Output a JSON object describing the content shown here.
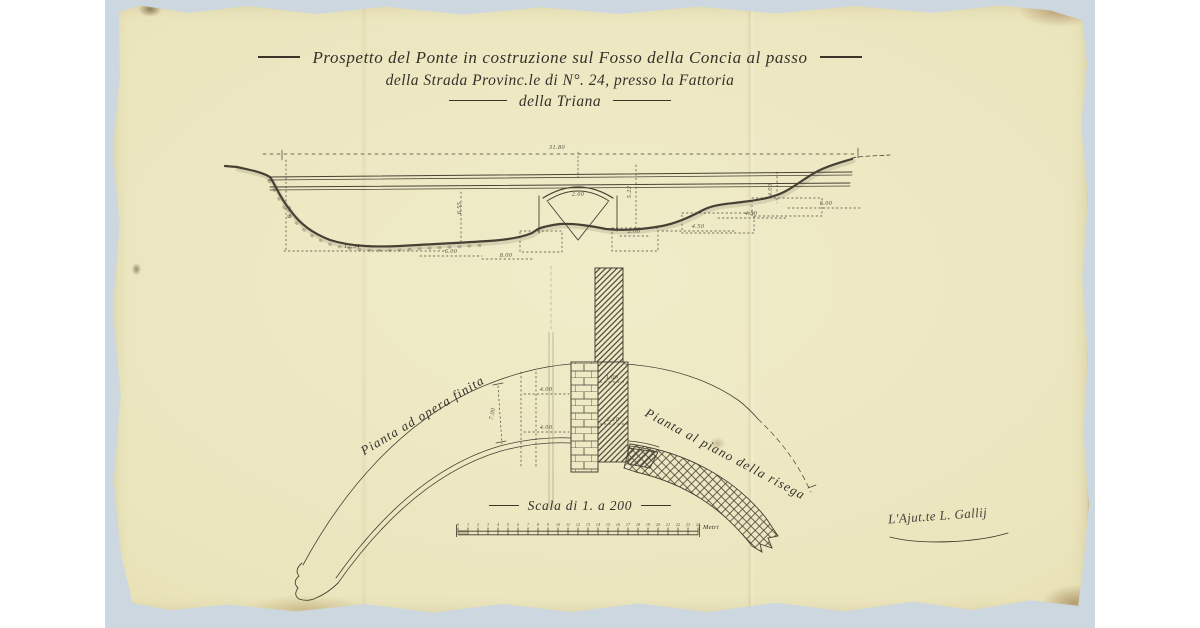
{
  "title": {
    "line1": "Prospetto del Ponte in costruzione sul Fosso della Concia al passo",
    "line2": "della Strada Provinc.le di N°. 24, presso la Fattoria",
    "line3": "della Triana"
  },
  "plan_labels": {
    "left": "Pianta ad opera finita",
    "right": "Pianta al piano della risega"
  },
  "scale": {
    "label": "Scala di 1. a 200",
    "unit": "Metri",
    "intervals": 24
  },
  "signature": "L'Ajut.te L. Gallij",
  "colors": {
    "paper": "#ebe5bd",
    "ink": "#3b352b",
    "scanner_bed": "#ccd7e0",
    "edge_tone": "#d3c48b"
  },
  "annotations": {
    "elevation": [
      {
        "text": "31.80",
        "x": 557,
        "y": 149,
        "rot": 0
      },
      {
        "text": "6.10",
        "x": 291,
        "y": 212,
        "rot": -90
      },
      {
        "text": "6.55",
        "x": 461,
        "y": 208,
        "rot": -90
      },
      {
        "text": "12.34",
        "x": 352,
        "y": 248,
        "rot": 0
      },
      {
        "text": "6.00",
        "x": 451,
        "y": 253,
        "rot": 0
      },
      {
        "text": "8.00",
        "x": 506,
        "y": 257,
        "rot": 0
      },
      {
        "text": "2.00",
        "x": 578,
        "y": 196,
        "rot": 0
      },
      {
        "text": "5.22",
        "x": 631,
        "y": 192,
        "rot": -90
      },
      {
        "text": "2.00",
        "x": 634,
        "y": 233,
        "rot": 0
      },
      {
        "text": "4.50",
        "x": 698,
        "y": 228,
        "rot": 0
      },
      {
        "text": "4.50",
        "x": 751,
        "y": 215,
        "rot": 0
      },
      {
        "text": "4.00",
        "x": 772,
        "y": 190,
        "rot": -90
      },
      {
        "text": "6.00",
        "x": 826,
        "y": 205,
        "rot": 0
      }
    ],
    "plan": [
      {
        "text": "7.00",
        "x": 494,
        "y": 414,
        "rot": -80
      },
      {
        "text": "4.00",
        "x": 546,
        "y": 391,
        "rot": 0
      },
      {
        "text": "1.00",
        "x": 612,
        "y": 379,
        "rot": 0
      },
      {
        "text": "2.10",
        "x": 613,
        "y": 421,
        "rot": 0
      },
      {
        "text": "4.00",
        "x": 546,
        "y": 429,
        "rot": 0
      }
    ]
  }
}
